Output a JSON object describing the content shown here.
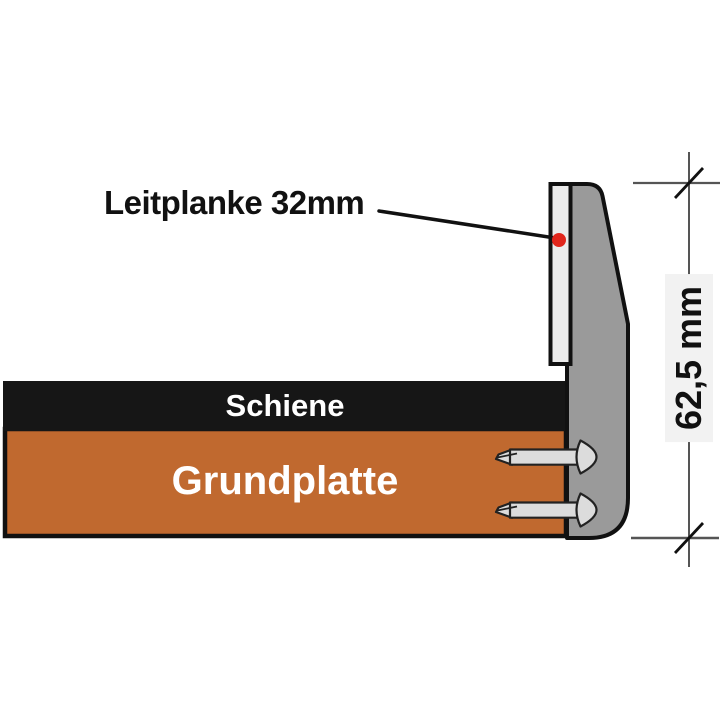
{
  "diagram": {
    "type": "technical-cross-section",
    "labels": {
      "guardrail": "Leitplanke 32mm",
      "rail": "Schiene",
      "base_plate": "Grundplatte",
      "dimension": "62,5 mm"
    },
    "colors": {
      "background": "#ffffff",
      "post": "#9a9a9a",
      "rail": "#161616",
      "base_plate": "#c0692f",
      "guardrail_strip": "#ebebeb",
      "marker_dot": "#e0251b",
      "screw": "#dcdcdc",
      "outline": "#111111",
      "dimension_line": "#555555",
      "text_dark": "#111111",
      "text_light": "#ffffff",
      "dimension_text_bg": "#f2f2f2"
    }
  }
}
